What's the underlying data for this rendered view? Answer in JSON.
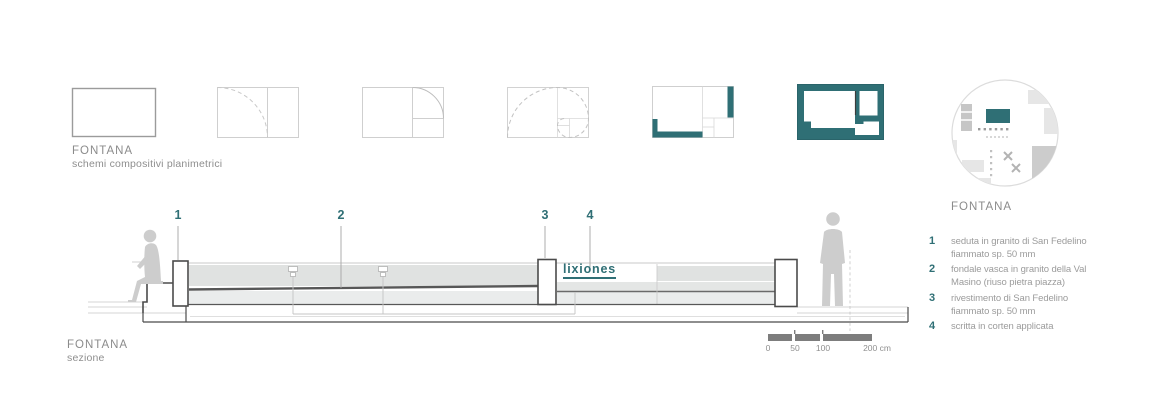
{
  "colors": {
    "teal_accent": "#2f6f75",
    "dark_line": "#4b4b4b",
    "gray_text": "#8b8b8b",
    "light_fill": "#e0e2e1",
    "silhouette": "#cdcdcd",
    "scalebar": "#7d7d7d"
  },
  "schemes": {
    "title": "FONTANA",
    "subtitle": "schemi compositivi planimetrici"
  },
  "section": {
    "label": "FONTANA",
    "sublabel": "sezione",
    "callouts": [
      "1",
      "2",
      "3",
      "4"
    ],
    "logo": "lixiones"
  },
  "scale_bar": {
    "labels": [
      "0",
      "50",
      "100",
      "200 cm"
    ]
  },
  "legend": {
    "title": "FONTANA",
    "items": [
      {
        "num": "1",
        "text": "seduta in granito di San Fedelino fiammato sp. 50 mm"
      },
      {
        "num": "2",
        "text": "fondale vasca in granito della Val Masino (riuso pietra piazza)"
      },
      {
        "num": "3",
        "text": "rivestimento di San Fedelino fiammato sp. 50 mm"
      },
      {
        "num": "4",
        "text": "scritta in corten applicata"
      }
    ]
  }
}
